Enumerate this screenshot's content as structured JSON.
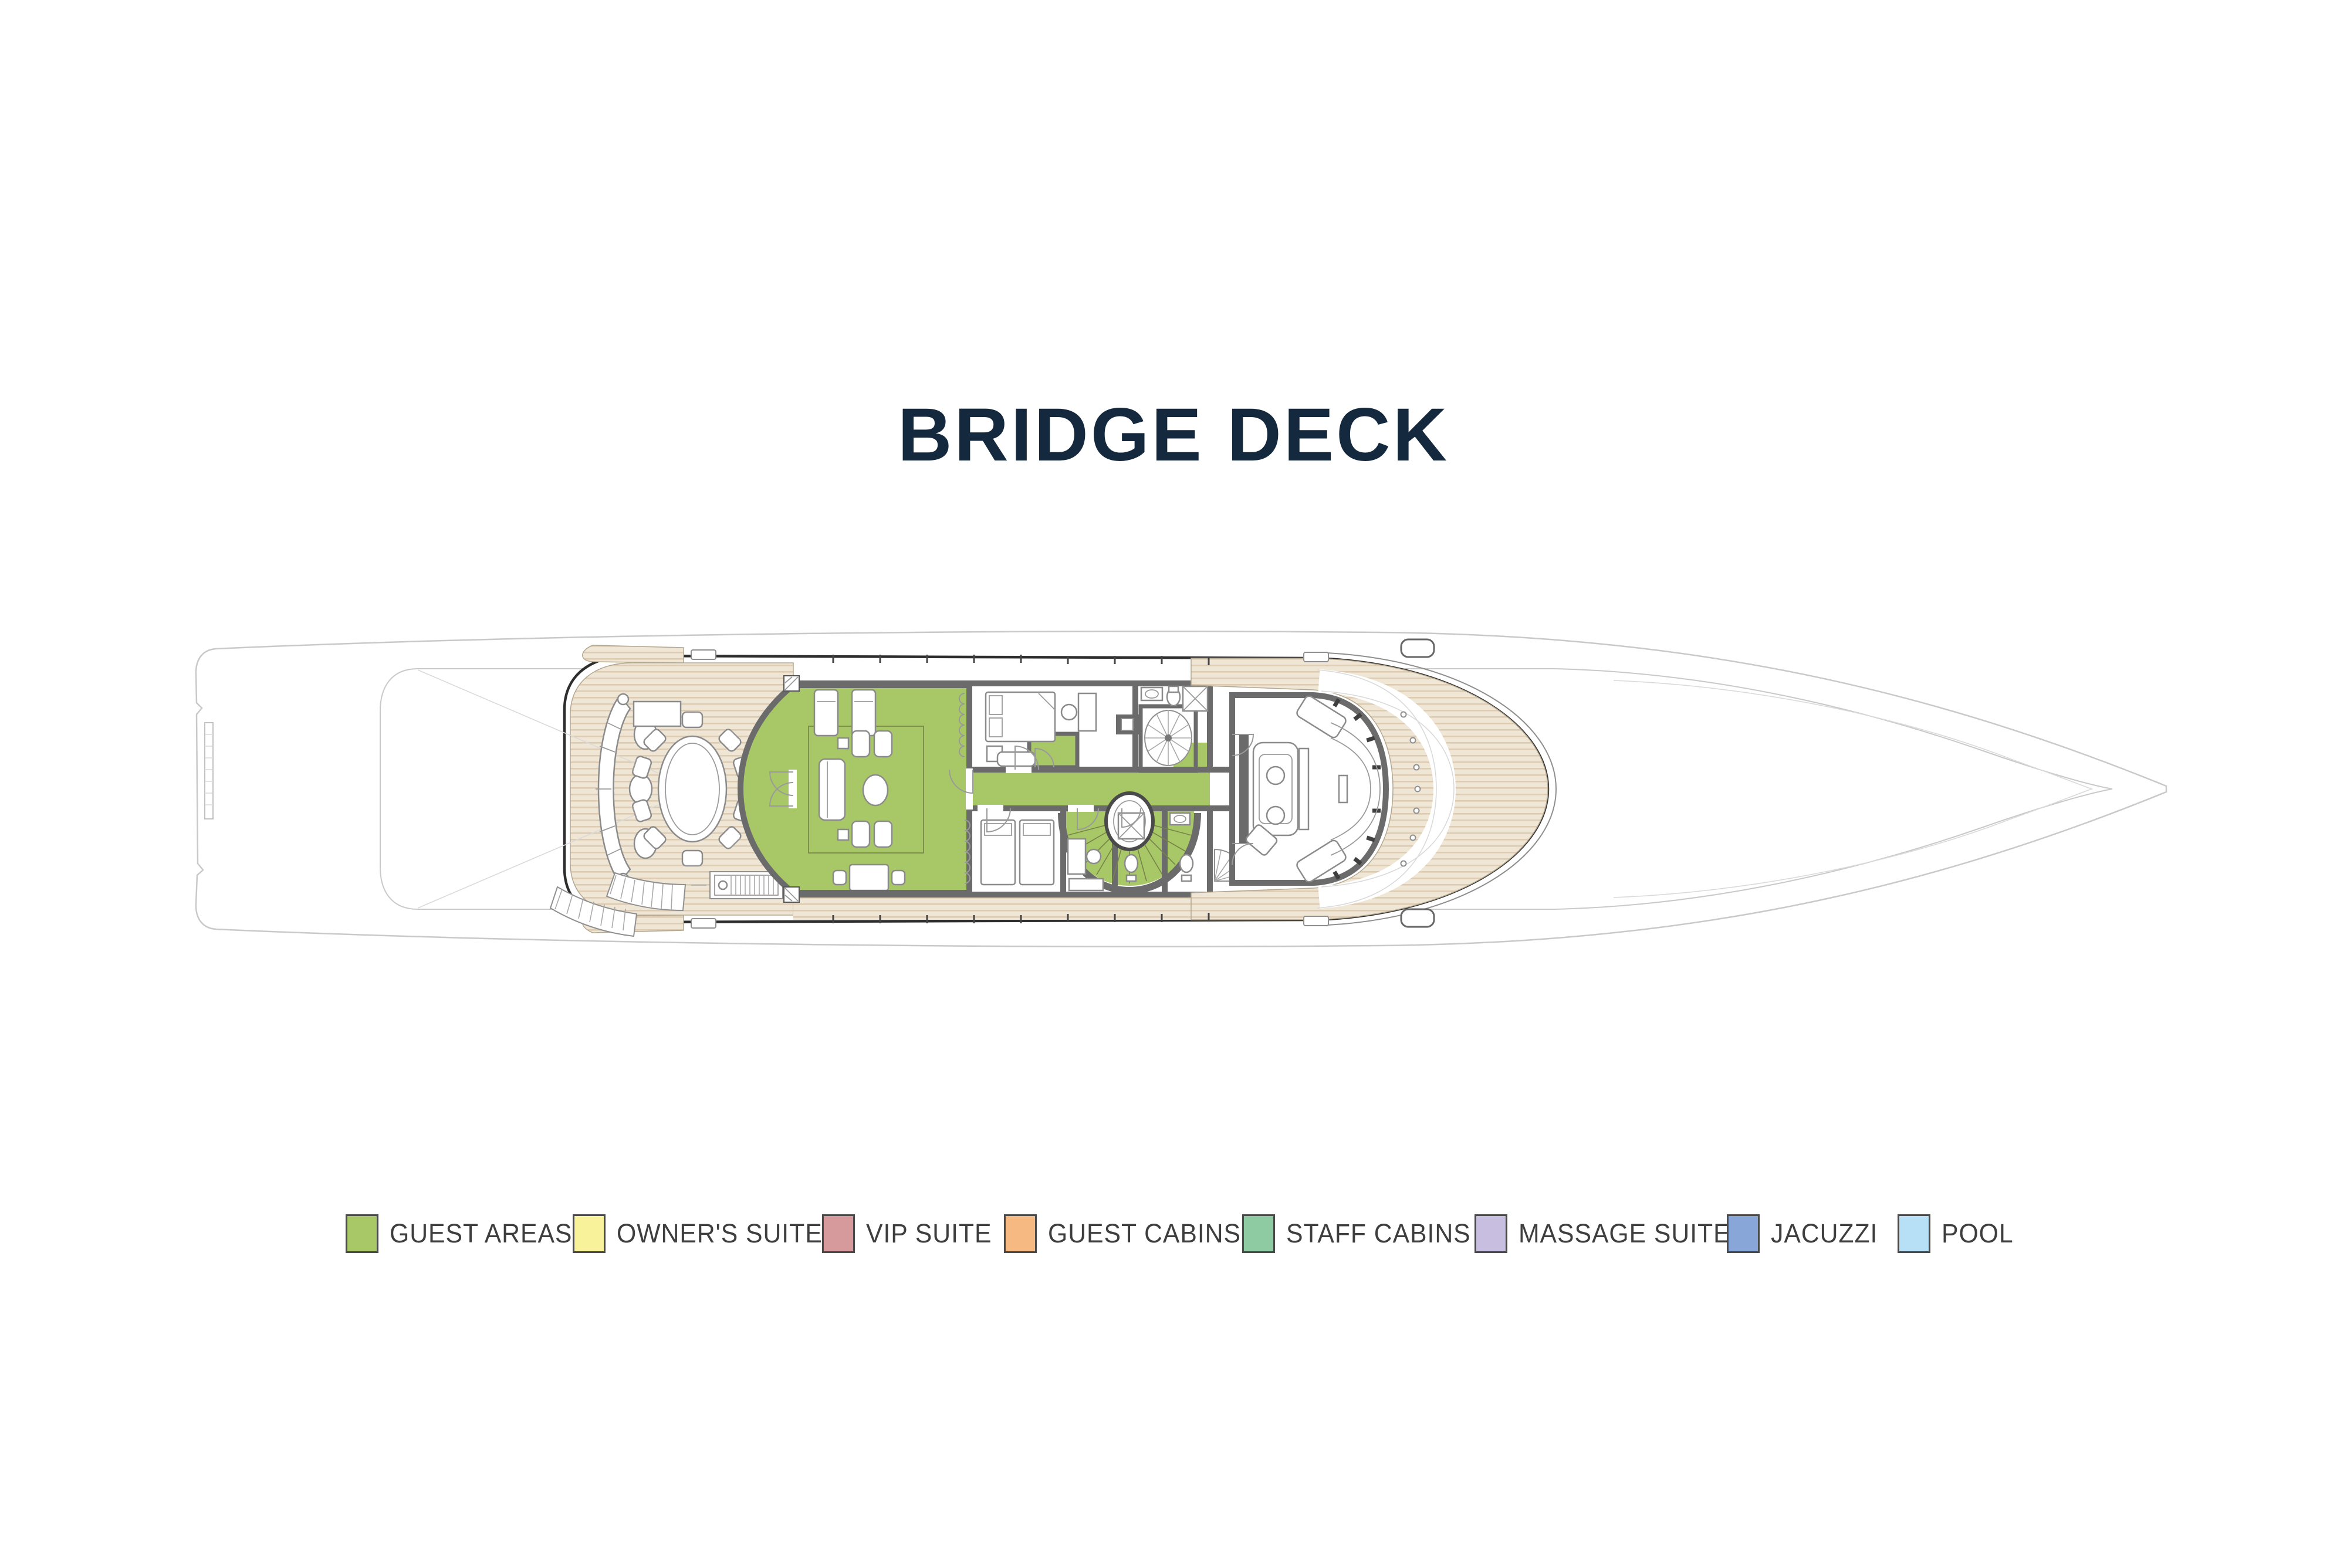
{
  "title": "BRIDGE DECK",
  "title_color": "#14293e",
  "legend": {
    "items": [
      {
        "id": "guest-areas",
        "label": "GUEST AREAS",
        "color": "#a8c766"
      },
      {
        "id": "owners-suite",
        "label": "OWNER'S SUITE",
        "color": "#f8f29a"
      },
      {
        "id": "vip-suite",
        "label": "VIP SUITE",
        "color": "#d79a9c"
      },
      {
        "id": "guest-cabins",
        "label": "GUEST CABINS",
        "color": "#f5b981"
      },
      {
        "id": "staff-cabins",
        "label": "STAFF CABINS",
        "color": "#8ecaa2"
      },
      {
        "id": "massage-suite",
        "label": "MASSAGE SUITE",
        "color": "#c8bfe0"
      },
      {
        "id": "jacuzzi",
        "label": "JACUZZI",
        "color": "#89a6d8"
      },
      {
        "id": "pool",
        "label": "POOL",
        "color": "#b7dff5"
      }
    ]
  },
  "plan": {
    "deck": "BRIDGE DECK",
    "highlighted_legend_category": "GUEST AREAS",
    "colors": {
      "guest_green": "#a8c766",
      "teak": "#f0e6d6",
      "teak_stripe": "#ddccb2",
      "wall": "#6b6b6b",
      "outline_dark": "#2e2e2e",
      "hull_faint": "#c9c9c9",
      "furniture": "#8b8b8b"
    }
  }
}
